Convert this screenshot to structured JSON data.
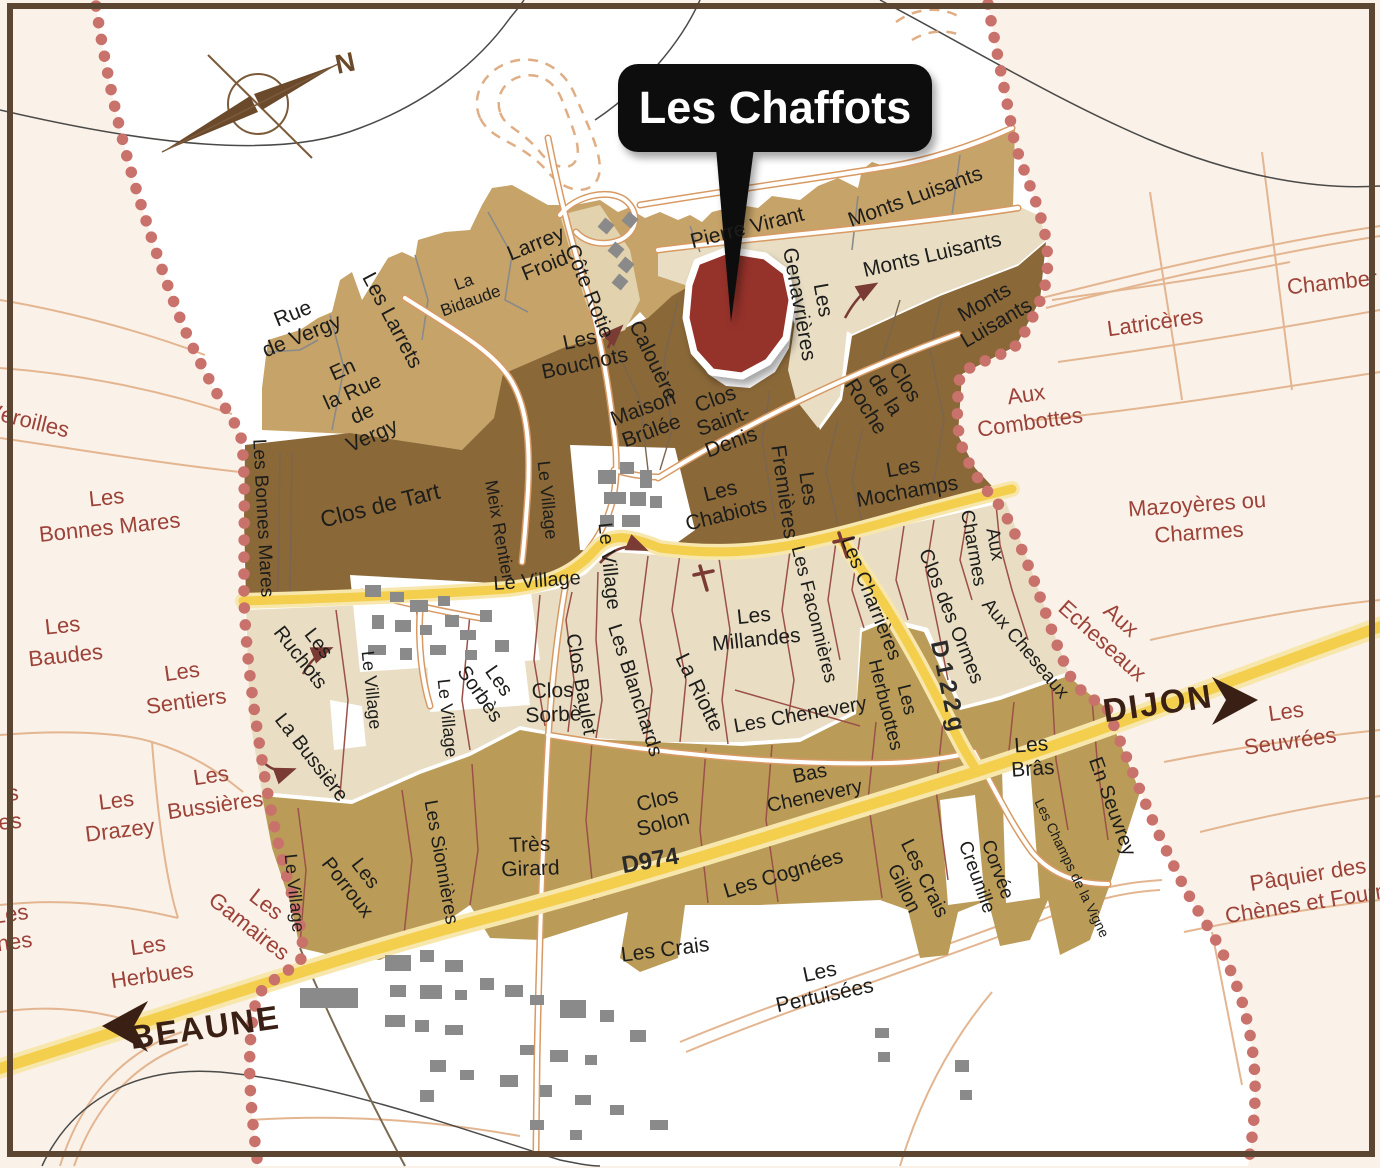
{
  "callout": {
    "label": "Les Chaffots"
  },
  "compass": {
    "north_label": "N"
  },
  "colors": {
    "outside_background": "#FAF1E8",
    "appellation_background": "#FFFFFF",
    "premier_cru_tan_north": "#C6A368",
    "grand_cru_dark_brown": "#8A6838",
    "light_beige_parcels": "#E9DEC4",
    "village_tan_south": "#BA9C58",
    "highlight_parcel_red": "#95302A",
    "boundary_dots_red": "#C9716B",
    "road_yellow": "#F3CF4D",
    "road_casing_orange": "#D89A64",
    "buildings_gray": "#8A8A8A",
    "outside_label_maroon": "#9C4238",
    "frame_brown": "#5C4531"
  },
  "map_labels": [
    {
      "id": "label-veroilles",
      "lines": [
        "Vèroilles"
      ],
      "x": 28,
      "y": 420,
      "r": 14,
      "fs": 22,
      "cls": "lo"
    },
    {
      "id": "label-les-bonnes-mares-outside",
      "lines": [
        "Les",
        "Bonnes Mares"
      ],
      "x": 108,
      "y": 512,
      "r": -6,
      "fs": 22,
      "cls": "lo",
      "lh": 30
    },
    {
      "id": "label-les-baudes",
      "lines": [
        "Les",
        "Baudes"
      ],
      "x": 64,
      "y": 640,
      "r": -6,
      "fs": 22,
      "cls": "lo",
      "lh": 30
    },
    {
      "id": "label-les-sentiers",
      "lines": [
        "Les",
        "Sentiers"
      ],
      "x": 184,
      "y": 686,
      "r": -8,
      "fs": 22,
      "cls": "lo",
      "lh": 30
    },
    {
      "id": "label-fragment-s",
      "lines": [
        "s",
        "ères"
      ],
      "x": 20,
      "y": 806,
      "r": -6,
      "fs": 22,
      "cls": "lo",
      "lh": 28,
      "anchor": "end"
    },
    {
      "id": "label-les-drazey",
      "lines": [
        "Les",
        "Drazey"
      ],
      "x": 118,
      "y": 815,
      "r": -7,
      "fs": 22,
      "cls": "lo",
      "lh": 30
    },
    {
      "id": "label-les-bussieres",
      "lines": [
        "Les",
        "Bussières"
      ],
      "x": 213,
      "y": 790,
      "r": -8,
      "fs": 22,
      "cls": "lo",
      "lh": 30
    },
    {
      "id": "label-fragment-rdannes",
      "lines": [
        "Les",
        "rdannes"
      ],
      "x": 30,
      "y": 925,
      "r": -8,
      "fs": 22,
      "cls": "lo",
      "lh": 28,
      "anchor": "end",
      "ax": 58
    },
    {
      "id": "label-les-herbues",
      "lines": [
        "Les",
        "Herbues"
      ],
      "x": 150,
      "y": 960,
      "r": -8,
      "fs": 22,
      "cls": "lo",
      "lh": 30
    },
    {
      "id": "label-les-gamaires",
      "lines": [
        "Les",
        "Gamaires"
      ],
      "x": 258,
      "y": 915,
      "r": 38,
      "fs": 22,
      "cls": "lo",
      "lh": 28
    },
    {
      "id": "label-latriceres",
      "lines": [
        "Latricères"
      ],
      "x": 1155,
      "y": 322,
      "r": -8,
      "fs": 22,
      "cls": "lo"
    },
    {
      "id": "label-chambertin-cut",
      "lines": [
        "Chamber"
      ],
      "x": 1332,
      "y": 282,
      "r": -6,
      "fs": 22,
      "cls": "lo"
    },
    {
      "id": "label-aux-combottes",
      "lines": [
        "Aux",
        "Combottes"
      ],
      "x": 1028,
      "y": 408,
      "r": -8,
      "fs": 22,
      "cls": "lo",
      "lh": 28
    },
    {
      "id": "label-mazoyeres-ou-charmes",
      "lines": [
        "Mazoyères ou",
        "Charmes"
      ],
      "x": 1198,
      "y": 518,
      "r": -4,
      "fs": 22,
      "cls": "lo",
      "lh": 28
    },
    {
      "id": "label-aux-echeseaux",
      "lines": [
        "Aux",
        "Echeseaux"
      ],
      "x": 1112,
      "y": 630,
      "r": 42,
      "fs": 22,
      "cls": "lo",
      "lh": 28
    },
    {
      "id": "label-les-seuvrees",
      "lines": [
        "Les",
        "Seuvrées"
      ],
      "x": 1288,
      "y": 726,
      "r": -8,
      "fs": 22,
      "cls": "lo",
      "lh": 30
    },
    {
      "id": "label-paquier-des-chenes",
      "lines": [
        "Pâquier des",
        "Chènes et Fourne"
      ],
      "x": 1310,
      "y": 888,
      "r": -9,
      "fs": 22,
      "cls": "lo",
      "lh": 28
    },
    {
      "id": "label-dijon",
      "lines": [
        "DIJON"
      ],
      "x": 1158,
      "y": 703,
      "r": -8,
      "fs": 33,
      "cls": "ld",
      "ls": 2
    },
    {
      "id": "label-beaune",
      "lines": [
        "BEAUNE"
      ],
      "x": 205,
      "y": 1027,
      "r": -8,
      "fs": 33,
      "cls": "ld",
      "ls": 2
    },
    {
      "id": "label-d974",
      "lines": [
        "D974"
      ],
      "x": 650,
      "y": 860,
      "r": -10,
      "fs": 24,
      "cls": "lr"
    },
    {
      "id": "label-d122g",
      "lines": [
        "D122g"
      ],
      "x": 949,
      "y": 688,
      "r": 78,
      "fs": 24,
      "cls": "lr",
      "ls": 5
    },
    {
      "id": "label-cote-rotie",
      "lines": [
        "Côte Rotie"
      ],
      "x": 590,
      "y": 291,
      "r": 68,
      "fs": 21,
      "cls": "lp"
    },
    {
      "id": "label-rue-de-vergy",
      "lines": [
        "Rue",
        "de Vergy"
      ],
      "x": 297,
      "y": 324,
      "r": -22,
      "fs": 21,
      "cls": "lp",
      "lh": 24
    },
    {
      "id": "label-en-la-rue-de-vergy",
      "lines": [
        "En",
        "la Rue",
        "de",
        "Vergy"
      ],
      "x": 357,
      "y": 402,
      "r": -24,
      "fs": 21,
      "cls": "lp",
      "lh": 24
    },
    {
      "id": "label-les-larrets",
      "lines": [
        "Les Larrets"
      ],
      "x": 393,
      "y": 320,
      "r": 62,
      "fs": 21,
      "cls": "lp"
    },
    {
      "id": "label-la-bidaude",
      "lines": [
        "La",
        "Bidaude"
      ],
      "x": 467,
      "y": 291,
      "r": -20,
      "fs": 17,
      "cls": "lp",
      "lh": 20
    },
    {
      "id": "label-larrey-froid",
      "lines": [
        "Larrey",
        "Froid"
      ],
      "x": 540,
      "y": 254,
      "r": -22,
      "fs": 21,
      "cls": "lp",
      "lh": 24
    },
    {
      "id": "label-pierre-virant",
      "lines": [
        "Pierre Virant"
      ],
      "x": 747,
      "y": 227,
      "r": -14,
      "fs": 21,
      "cls": "lp"
    },
    {
      "id": "label-monts-luisants-top",
      "lines": [
        "Monts Luisants"
      ],
      "x": 915,
      "y": 196,
      "r": -20,
      "fs": 21,
      "cls": "lp"
    },
    {
      "id": "label-monts-luisants-mid",
      "lines": [
        "Monts Luisants"
      ],
      "x": 932,
      "y": 254,
      "r": -13,
      "fs": 21,
      "cls": "lp"
    },
    {
      "id": "label-monts-luisants-dark",
      "lines": [
        "Monts",
        "Luisants"
      ],
      "x": 990,
      "y": 312,
      "r": -30,
      "fs": 21,
      "cls": "lp",
      "lh": 24
    },
    {
      "id": "label-calouere",
      "lines": [
        "Calouère"
      ],
      "x": 654,
      "y": 360,
      "r": 64,
      "fs": 21,
      "cls": "lp"
    },
    {
      "id": "label-les-bouchots",
      "lines": [
        "Les",
        "Bouchots"
      ],
      "x": 582,
      "y": 351,
      "r": -12,
      "fs": 21,
      "cls": "lp",
      "lh": 24
    },
    {
      "id": "label-les-genavrieres",
      "lines": [
        "Les",
        "Genavrières"
      ],
      "x": 812,
      "y": 302,
      "r": 80,
      "fs": 21,
      "cls": "lp",
      "lh": 24
    },
    {
      "id": "label-maison-brulee",
      "lines": [
        "Maison",
        "Brûlée"
      ],
      "x": 647,
      "y": 419,
      "r": -20,
      "fs": 21,
      "cls": "lp",
      "lh": 24
    },
    {
      "id": "label-clos-saint-denis",
      "lines": [
        "Clos",
        "Saint-",
        "Denis"
      ],
      "x": 723,
      "y": 420,
      "r": -20,
      "fs": 21,
      "cls": "lp",
      "lh": 23
    },
    {
      "id": "label-clos-de-la-roche",
      "lines": [
        "Clos",
        "de la",
        "Roche"
      ],
      "x": 886,
      "y": 394,
      "r": 58,
      "fs": 21,
      "cls": "lp",
      "lh": 23
    },
    {
      "id": "label-les-fremieres",
      "lines": [
        "Les",
        "Fremières"
      ],
      "x": 797,
      "y": 490,
      "r": 82,
      "fs": 21,
      "cls": "lp",
      "lh": 24
    },
    {
      "id": "label-les-chabiots",
      "lines": [
        "Les",
        "Chabiots"
      ],
      "x": 723,
      "y": 502,
      "r": -14,
      "fs": 21,
      "cls": "lp",
      "lh": 24
    },
    {
      "id": "label-les-mochamps",
      "lines": [
        "Les",
        "Mochamps"
      ],
      "x": 905,
      "y": 479,
      "r": -10,
      "fs": 21,
      "cls": "lp",
      "lh": 24
    },
    {
      "id": "label-clos-de-tart",
      "lines": [
        "Clos de Tart"
      ],
      "x": 380,
      "y": 505,
      "r": -14,
      "fs": 23,
      "cls": "lp"
    },
    {
      "id": "label-les-bonnes-mares-in",
      "lines": [
        "Les Bonnes Mares"
      ],
      "x": 264,
      "y": 518,
      "r": 87,
      "fs": 19,
      "cls": "lp"
    },
    {
      "id": "label-meix-rentier",
      "lines": [
        "Meix Rentier"
      ],
      "x": 500,
      "y": 530,
      "r": 80,
      "fs": 18,
      "cls": "lp"
    },
    {
      "id": "label-le-village-v1",
      "lines": [
        "Le Village"
      ],
      "x": 548,
      "y": 500,
      "r": 84,
      "fs": 18,
      "cls": "lp"
    },
    {
      "id": "label-le-village-h",
      "lines": [
        "Le Village"
      ],
      "x": 537,
      "y": 580,
      "r": -4,
      "fs": 20,
      "cls": "lp"
    },
    {
      "id": "label-le-village-v2",
      "lines": [
        "Le Village"
      ],
      "x": 610,
      "y": 566,
      "r": 84,
      "fs": 20,
      "cls": "lp"
    },
    {
      "id": "label-le-village-v3",
      "lines": [
        "Le Village"
      ],
      "x": 372,
      "y": 690,
      "r": 84,
      "fs": 18,
      "cls": "lp"
    },
    {
      "id": "label-le-village-v4",
      "lines": [
        "Le Village"
      ],
      "x": 448,
      "y": 718,
      "r": 84,
      "fs": 18,
      "cls": "lp"
    },
    {
      "id": "label-le-village-v5",
      "lines": [
        "Le Village"
      ],
      "x": 295,
      "y": 893,
      "r": 84,
      "fs": 18,
      "cls": "lp"
    },
    {
      "id": "label-les-ruchots",
      "lines": [
        "Les",
        "Ruchots"
      ],
      "x": 310,
      "y": 650,
      "r": 52,
      "fs": 20,
      "cls": "lp",
      "lh": 23
    },
    {
      "id": "label-la-bussiere",
      "lines": [
        "La Bussière"
      ],
      "x": 312,
      "y": 757,
      "r": 52,
      "fs": 20,
      "cls": "lp"
    },
    {
      "id": "label-les-sorbes",
      "lines": [
        "Les",
        "Sorbès"
      ],
      "x": 490,
      "y": 687,
      "r": 55,
      "fs": 20,
      "cls": "lp",
      "lh": 23
    },
    {
      "id": "label-clos-sorbe",
      "lines": [
        "Clos",
        "Sorbè"
      ],
      "x": 553,
      "y": 702,
      "r": -2,
      "fs": 21,
      "cls": "lp",
      "lh": 24
    },
    {
      "id": "label-clos-baulet",
      "lines": [
        "Clos Baulet"
      ],
      "x": 582,
      "y": 684,
      "r": 80,
      "fs": 20,
      "cls": "lp"
    },
    {
      "id": "label-les-blanchards",
      "lines": [
        "Les Blanchards"
      ],
      "x": 636,
      "y": 690,
      "r": 72,
      "fs": 20,
      "cls": "lp"
    },
    {
      "id": "label-la-riotte",
      "lines": [
        "La Riotte"
      ],
      "x": 700,
      "y": 692,
      "r": 64,
      "fs": 21,
      "cls": "lp"
    },
    {
      "id": "label-les-millandes",
      "lines": [
        "Les",
        "Millandes"
      ],
      "x": 755,
      "y": 627,
      "r": -6,
      "fs": 21,
      "cls": "lp",
      "lh": 24
    },
    {
      "id": "label-les-faconnieres",
      "lines": [
        "Les Faconnières"
      ],
      "x": 815,
      "y": 614,
      "r": 76,
      "fs": 19,
      "cls": "lp"
    },
    {
      "id": "label-les-charrieres",
      "lines": [
        "Les Charrières"
      ],
      "x": 872,
      "y": 598,
      "r": 68,
      "fs": 20,
      "cls": "lp"
    },
    {
      "id": "label-clos-des-ormes",
      "lines": [
        "Clos des Ormes"
      ],
      "x": 952,
      "y": 616,
      "r": 68,
      "fs": 20,
      "cls": "lp"
    },
    {
      "id": "label-aux-charmes",
      "lines": [
        "Aux",
        "Charmes"
      ],
      "x": 985,
      "y": 546,
      "r": 80,
      "fs": 19,
      "cls": "lp",
      "lh": 22
    },
    {
      "id": "label-aux-cheseaux",
      "lines": [
        "Aux Cheseaux"
      ],
      "x": 1026,
      "y": 648,
      "r": 50,
      "fs": 19,
      "cls": "lp"
    },
    {
      "id": "label-les-chenevery",
      "lines": [
        "Les Chenevery"
      ],
      "x": 800,
      "y": 714,
      "r": -10,
      "fs": 20,
      "cls": "lp"
    },
    {
      "id": "label-les-herbuottes",
      "lines": [
        "Les",
        "Herbuottes"
      ],
      "x": 897,
      "y": 702,
      "r": 76,
      "fs": 19,
      "cls": "lp",
      "lh": 22
    },
    {
      "id": "label-bas-chenevery",
      "lines": [
        "Bas",
        "Chenevery"
      ],
      "x": 812,
      "y": 784,
      "r": -12,
      "fs": 20,
      "cls": "lp",
      "lh": 23
    },
    {
      "id": "label-les-bras",
      "lines": [
        "Les",
        "Brâs"
      ],
      "x": 1032,
      "y": 756,
      "r": -4,
      "fs": 21,
      "cls": "lp",
      "lh": 24
    },
    {
      "id": "label-les-porroux",
      "lines": [
        "Les",
        "Porroux"
      ],
      "x": 357,
      "y": 880,
      "r": 52,
      "fs": 20,
      "cls": "lp",
      "lh": 23
    },
    {
      "id": "label-les-sionnieres",
      "lines": [
        "Les Sionnières"
      ],
      "x": 442,
      "y": 862,
      "r": 80,
      "fs": 19,
      "cls": "lp"
    },
    {
      "id": "label-tres-girard",
      "lines": [
        "Très",
        "Girard"
      ],
      "x": 530,
      "y": 856,
      "r": -2,
      "fs": 21,
      "cls": "lp",
      "lh": 24
    },
    {
      "id": "label-clos-solon",
      "lines": [
        "Clos",
        "Solon"
      ],
      "x": 660,
      "y": 811,
      "r": -14,
      "fs": 21,
      "cls": "lp",
      "lh": 24
    },
    {
      "id": "label-les-cognees",
      "lines": [
        "Les Cognées"
      ],
      "x": 783,
      "y": 873,
      "r": -17,
      "fs": 21,
      "cls": "lp"
    },
    {
      "id": "label-les-crais",
      "lines": [
        "Les Crais"
      ],
      "x": 665,
      "y": 949,
      "r": -7,
      "fs": 21,
      "cls": "lp"
    },
    {
      "id": "label-les-crais-gillon",
      "lines": [
        "Les Crais",
        "Gillon"
      ],
      "x": 915,
      "y": 883,
      "r": 64,
      "fs": 20,
      "cls": "lp",
      "lh": 23
    },
    {
      "id": "label-corvee-creunille",
      "lines": [
        "Corvée",
        "Creunille"
      ],
      "x": 988,
      "y": 873,
      "r": 70,
      "fs": 19,
      "cls": "lp",
      "lh": 22
    },
    {
      "id": "label-les-champs-de-la-vigne",
      "lines": [
        "Les Champs de la Vigne"
      ],
      "x": 1072,
      "y": 868,
      "r": 64,
      "fs": 14,
      "cls": "lp"
    },
    {
      "id": "label-en-seuvrey",
      "lines": [
        "En Seuvrey"
      ],
      "x": 1113,
      "y": 806,
      "r": 70,
      "fs": 20,
      "cls": "lp"
    },
    {
      "id": "label-les-pertuisees",
      "lines": [
        "Les",
        "Pertuisées"
      ],
      "x": 822,
      "y": 983,
      "r": -12,
      "fs": 21,
      "cls": "lp",
      "lh": 24
    }
  ]
}
